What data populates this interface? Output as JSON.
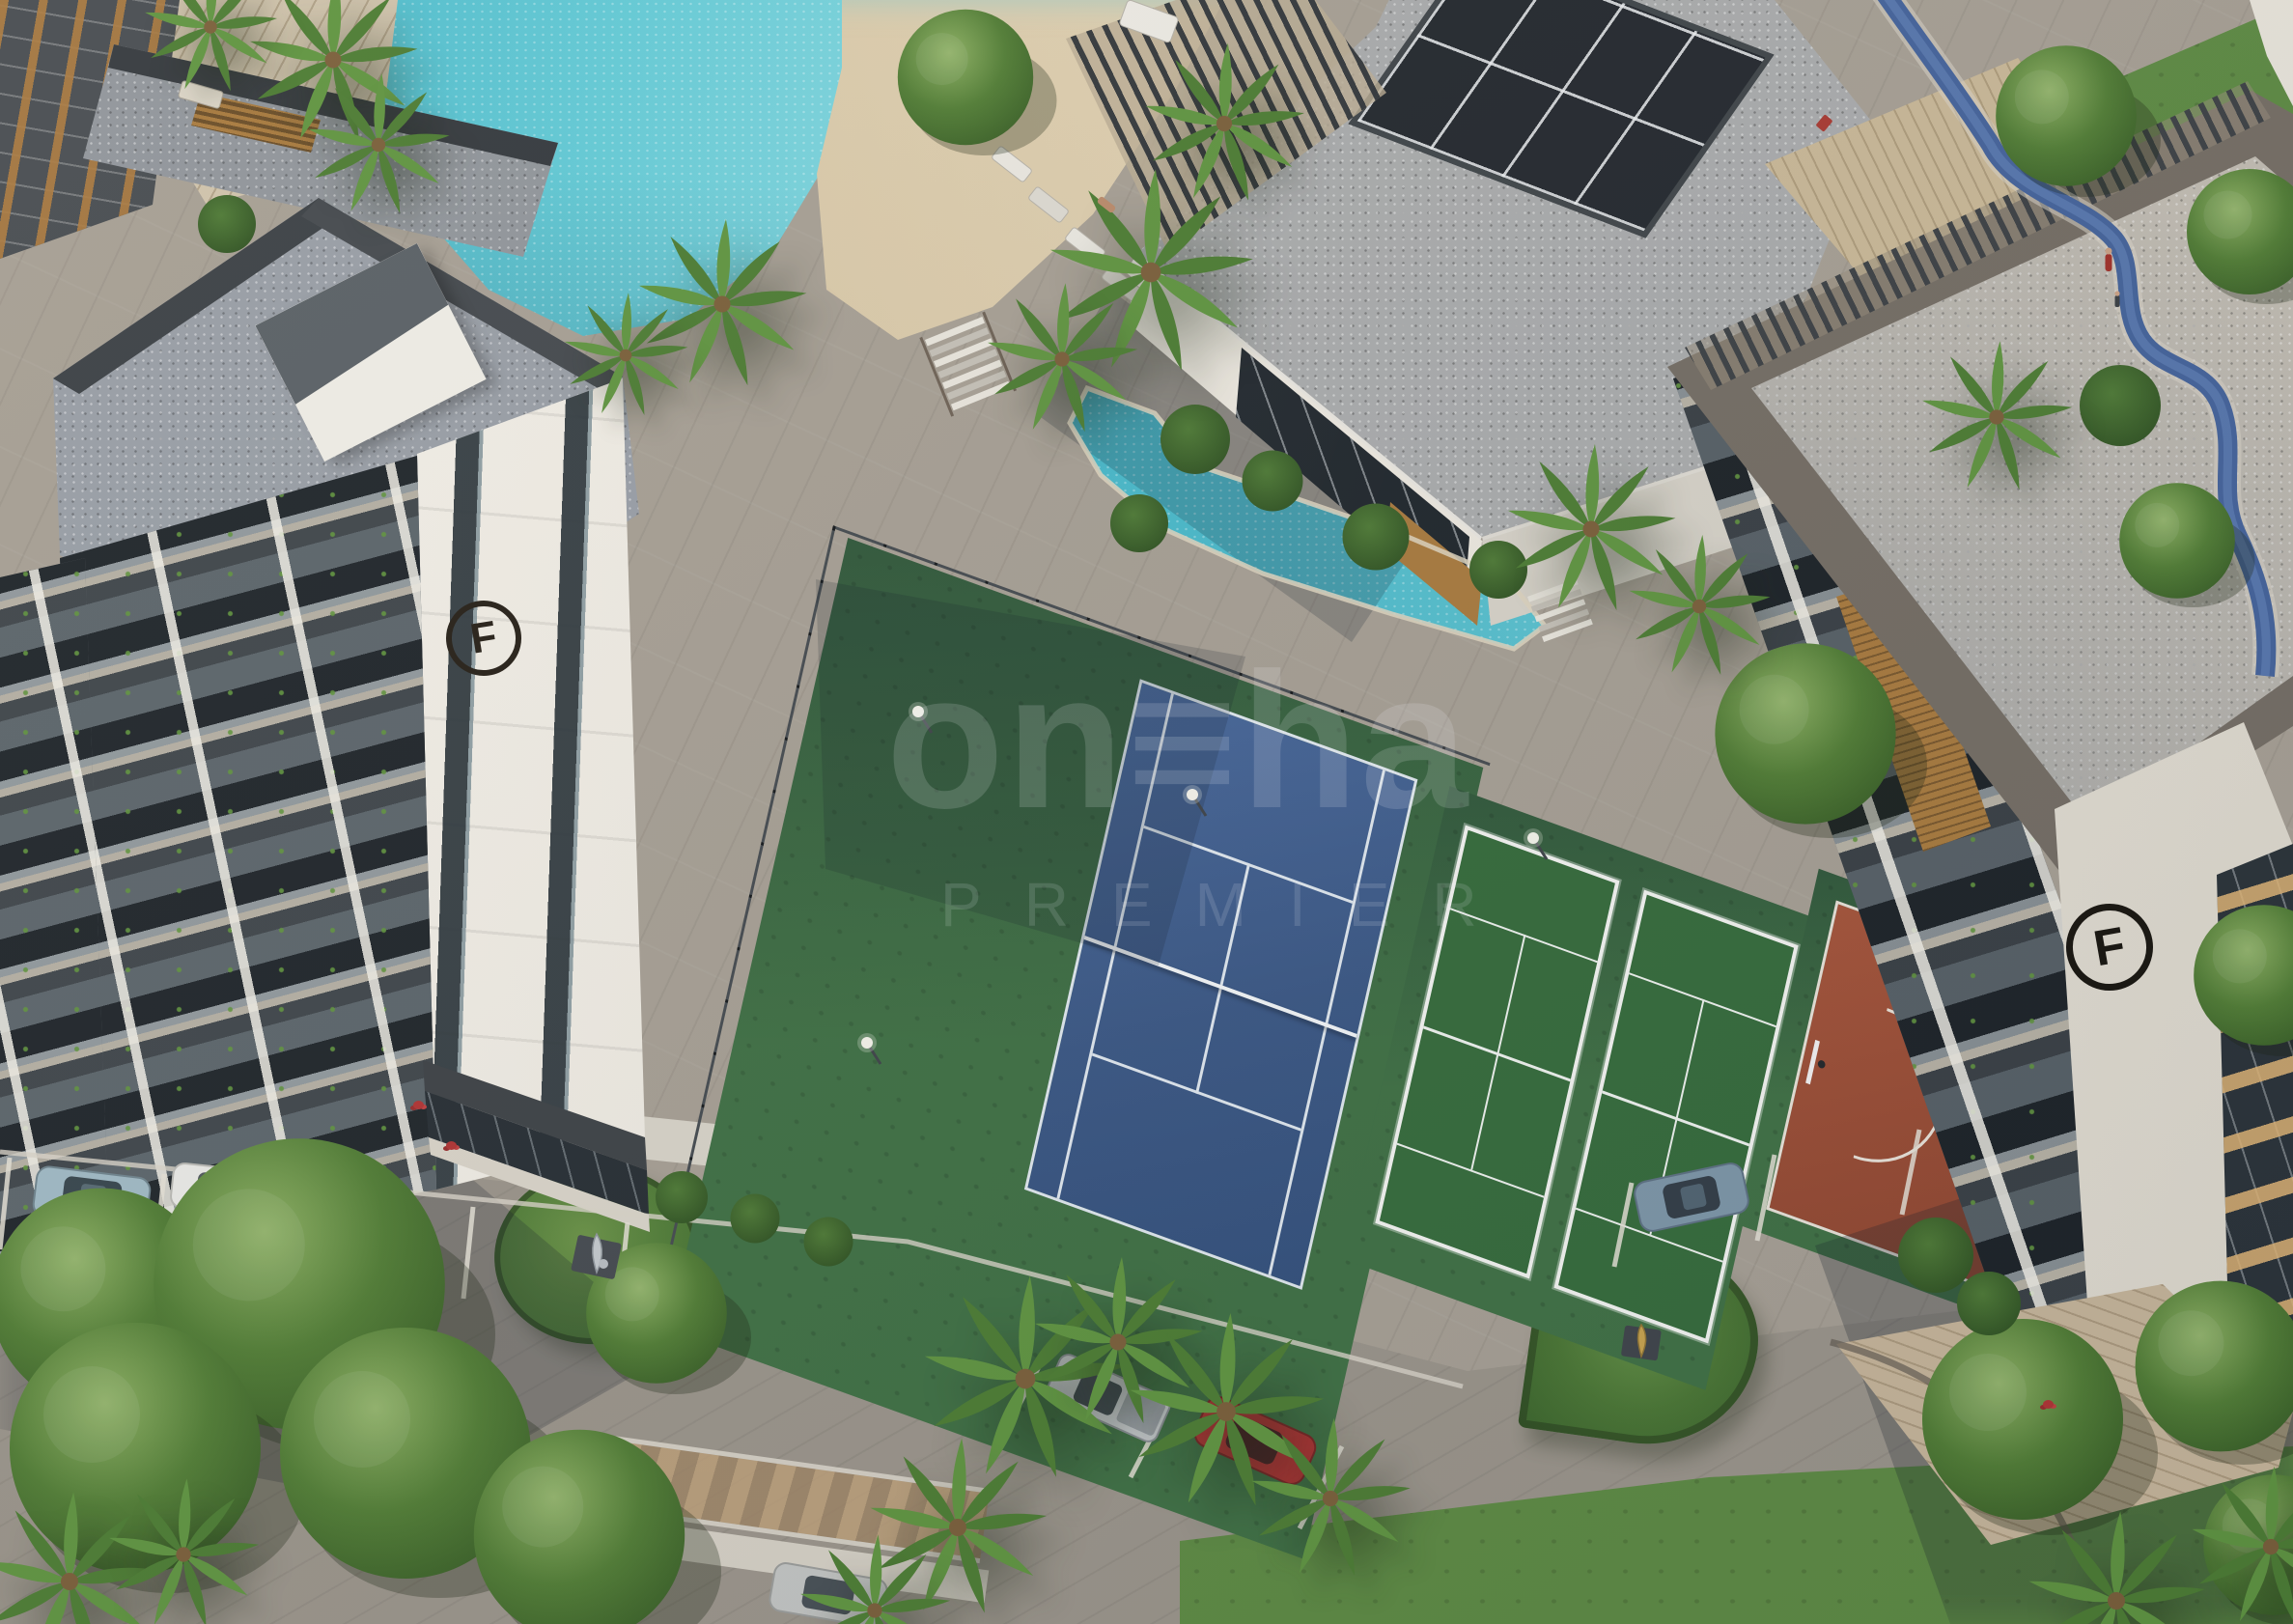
{
  "image": {
    "description": "Dusk aerial 3D architectural rendering of a residential complex: lagoon-style pool with sand beach, clubhouse with skylight roof, blue tennis court, two white-framed padel courts, terracotta basketball half-court, two apartment towers with gravel roofs and balconies, palm trees, gardens with sculptures, roads and parked cars",
    "style": "architectural-render"
  },
  "watermark": {
    "main_text": "on≡ha",
    "sub_text": "PREMIER"
  },
  "buildings": {
    "left_tower_logo_letter": "F",
    "right_tower_logo_letter": "F"
  },
  "palette": {
    "water": "#45b9cc",
    "sand": "#dccfae",
    "pavement": "#a69f94",
    "court_blue": "#3f5f8e",
    "court_green": "#3f7044",
    "terracotta": "#9c5138",
    "lawn": "#5d8a43",
    "roof_gravel": "#9aa0a8",
    "white_wall": "#f2efe8",
    "dark_panel": "#3a4045",
    "wood_accent": "#a87a3e",
    "track_blue": "#44639b"
  },
  "vehicles": [
    {
      "type": "suv",
      "color_name": "light blue",
      "hex": "#9fb9c4"
    },
    {
      "type": "sedan",
      "color_name": "white",
      "hex": "#e9e9e6"
    },
    {
      "type": "pickup",
      "color_name": "silver",
      "hex": "#c7cbcd"
    },
    {
      "type": "hatchback",
      "color_name": "red",
      "hex": "#b23434"
    },
    {
      "type": "suv",
      "color_name": "steel blue",
      "hex": "#7d96a8"
    },
    {
      "type": "sedan",
      "color_name": "silver",
      "hex": "#c2c4c2"
    }
  ]
}
